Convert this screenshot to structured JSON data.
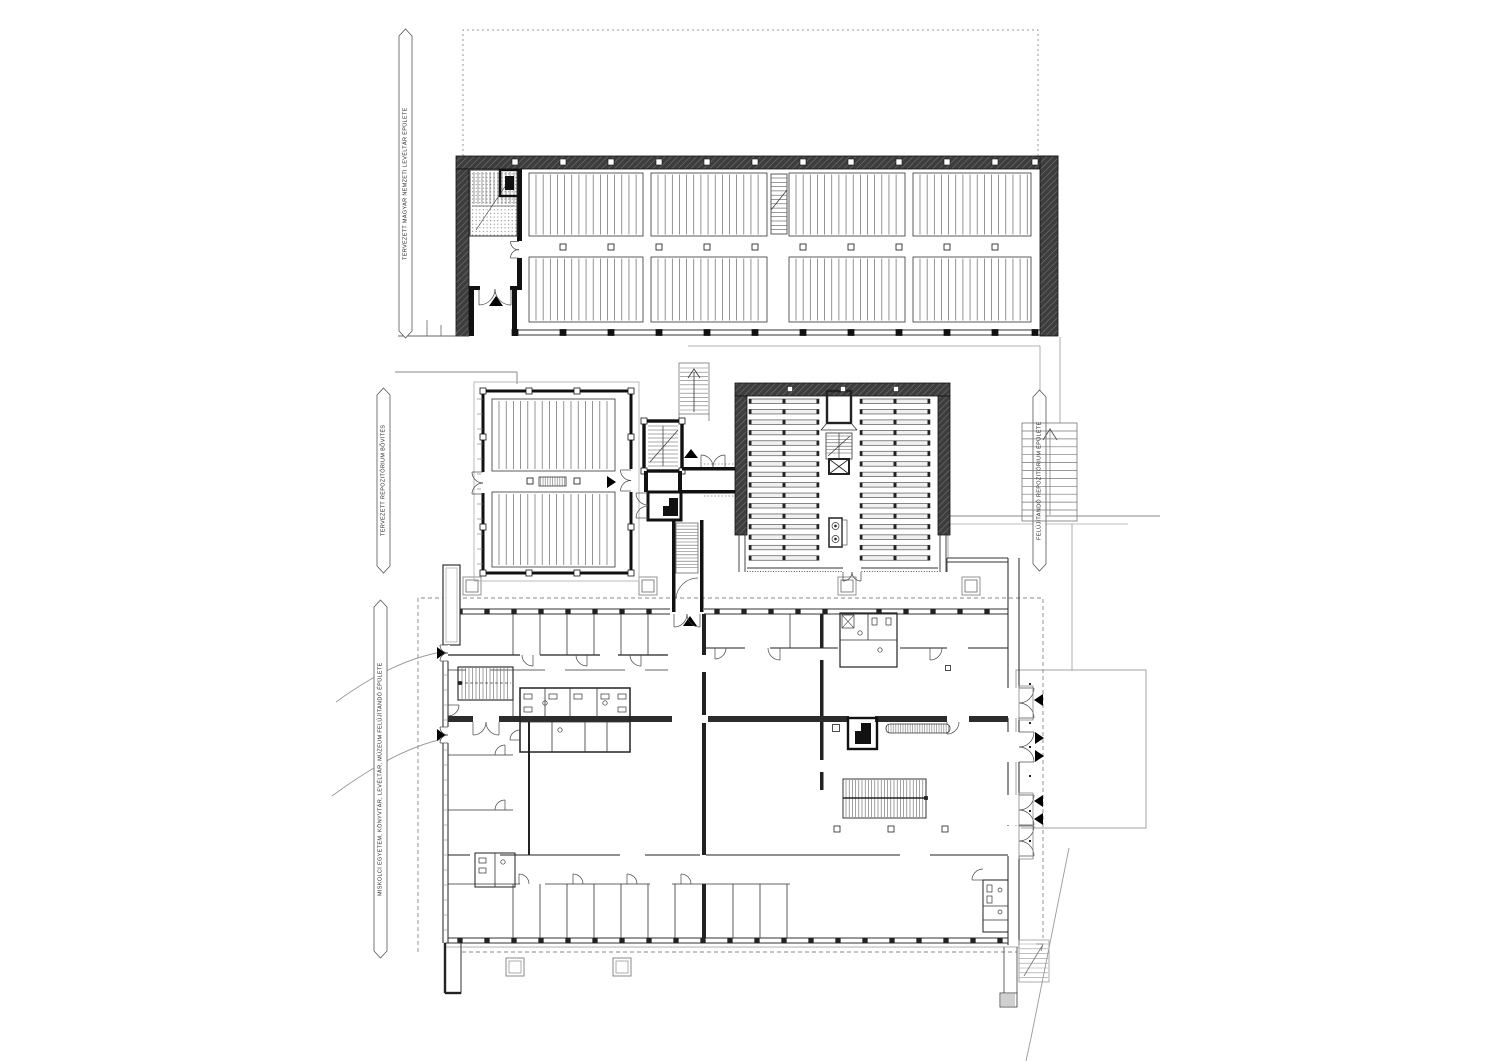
{
  "plan": {
    "type": "architectural-floor-plan",
    "annotations": {
      "top_left_label": "TERVEZETT MAGYAR NEMZETI LEVÉLTÁR ÉPÜLETE",
      "mid_left_label": "TERVEZETT REPOZITÓRIUM BŐVÍTÉS",
      "bottom_left_label": "MISKOLCI EGYETEM, KÖNYVTÁR, LEVÉLTÁR, MÚZEUM FELÚJÍTANDÓ ÉPÜLETE",
      "right_label": "FELÚJÍTANDÓ REPOZITÓRIUM ÉPÜLETE"
    },
    "colors": {
      "ink": "#1a1a1a",
      "wall_dark": "#3d3d3d",
      "wall_hatch_line": "#6f6f6f",
      "light_line": "#888888",
      "background": "#ffffff"
    },
    "buildings": [
      {
        "name": "planned archive hall (top)",
        "content": "two rows of mobile shelving blocks, stair core, entrance"
      },
      {
        "name": "planned repository extension (middle left)",
        "content": "two shelving blocks, central aisle, lift and stair core"
      },
      {
        "name": "repository (middle right)",
        "content": "two columns of 16 shelving rows, central stair and lifts"
      },
      {
        "name": "existing university library / archive / museum building (bottom)",
        "content": "cellular rooms, corridors, two halls, lobby with grand stair, WC groups, terrace entrances"
      }
    ]
  }
}
